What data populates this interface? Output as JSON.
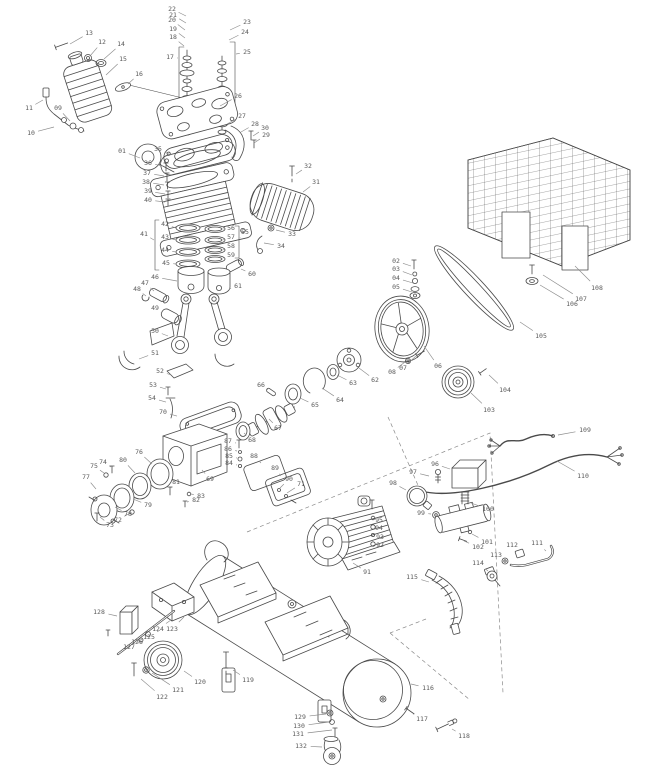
{
  "meta": {
    "title": "Air compressor exploded parts diagram"
  },
  "diagram": {
    "colors": {
      "line": "#4a4a4a",
      "dash": "#8a8a8a",
      "label": "#595959",
      "leader": "#8c8c8c",
      "background": "#ffffff"
    },
    "parts": [
      {
        "n": "01",
        "x": 122,
        "y": 151,
        "tx": 140,
        "ty": 158
      },
      {
        "n": "02",
        "x": 396,
        "y": 261,
        "tx": 411,
        "ty": 266
      },
      {
        "n": "03",
        "x": 396,
        "y": 269,
        "tx": 412,
        "ty": 275
      },
      {
        "n": "04",
        "x": 396,
        "y": 278,
        "tx": 413,
        "ty": 283
      },
      {
        "n": "05",
        "x": 396,
        "y": 287,
        "tx": 412,
        "ty": 292
      },
      {
        "n": "06",
        "x": 438,
        "y": 366,
        "tx": 424,
        "ty": 346
      },
      {
        "n": "07",
        "x": 403,
        "y": 368,
        "tx": 416,
        "ty": 356
      },
      {
        "n": "08",
        "x": 392,
        "y": 372,
        "tx": 405,
        "ty": 362
      },
      {
        "n": "09",
        "x": 58,
        "y": 108,
        "tx": 70,
        "ty": 121
      },
      {
        "n": "10",
        "x": 31,
        "y": 133,
        "tx": 54,
        "ty": 127
      },
      {
        "n": "11",
        "x": 29,
        "y": 108,
        "tx": 43,
        "ty": 100
      },
      {
        "n": "12",
        "x": 102,
        "y": 42,
        "tx": 90,
        "ty": 56
      },
      {
        "n": "13",
        "x": 89,
        "y": 33,
        "tx": 70,
        "ty": 44
      },
      {
        "n": "14",
        "x": 121,
        "y": 44,
        "tx": 104,
        "ty": 59
      },
      {
        "n": "15",
        "x": 123,
        "y": 59,
        "tx": 106,
        "ty": 75
      },
      {
        "n": "16",
        "x": 139,
        "y": 74,
        "tx": 128,
        "ty": 84
      },
      {
        "n": "17",
        "x": 170,
        "y": 57,
        "tx": 178,
        "ty": 58
      },
      {
        "n": "18",
        "x": 173,
        "y": 37,
        "tx": 184,
        "ty": 46
      },
      {
        "n": "19",
        "x": 173,
        "y": 29,
        "tx": 185,
        "ty": 38
      },
      {
        "n": "20",
        "x": 172,
        "y": 20,
        "tx": 185,
        "ty": 30
      },
      {
        "n": "21",
        "x": 173,
        "y": 15,
        "tx": 186,
        "ty": 23
      },
      {
        "n": "22",
        "x": 172,
        "y": 9,
        "tx": 186,
        "ty": 16
      },
      {
        "n": "23",
        "x": 247,
        "y": 22,
        "tx": 230,
        "ty": 30
      },
      {
        "n": "24",
        "x": 245,
        "y": 32,
        "tx": 229,
        "ty": 40
      },
      {
        "n": "25",
        "x": 247,
        "y": 52,
        "tx": 236,
        "ty": 54
      },
      {
        "n": "26",
        "x": 238,
        "y": 96,
        "tx": 220,
        "ty": 106
      },
      {
        "n": "27",
        "x": 242,
        "y": 116,
        "tx": 227,
        "ty": 124
      },
      {
        "n": "28",
        "x": 255,
        "y": 124,
        "tx": 241,
        "ty": 132
      },
      {
        "n": "29",
        "x": 266,
        "y": 135,
        "tx": 254,
        "ty": 143
      },
      {
        "n": "30",
        "x": 265,
        "y": 128,
        "tx": 253,
        "ty": 136
      },
      {
        "n": "31",
        "x": 316,
        "y": 182,
        "tx": 303,
        "ty": 192
      },
      {
        "n": "32",
        "x": 308,
        "y": 166,
        "tx": 296,
        "ty": 174
      },
      {
        "n": "33",
        "x": 292,
        "y": 234,
        "tx": 276,
        "ty": 230
      },
      {
        "n": "34",
        "x": 281,
        "y": 246,
        "tx": 264,
        "ty": 243
      },
      {
        "n": "35",
        "x": 158,
        "y": 149,
        "tx": 171,
        "ty": 155
      },
      {
        "n": "36",
        "x": 148,
        "y": 163,
        "tx": 163,
        "ty": 166
      },
      {
        "n": "37",
        "x": 147,
        "y": 173,
        "tx": 164,
        "ty": 176
      },
      {
        "n": "38",
        "x": 146,
        "y": 182,
        "tx": 164,
        "ty": 185
      },
      {
        "n": "39",
        "x": 148,
        "y": 191,
        "tx": 165,
        "ty": 194
      },
      {
        "n": "40",
        "x": 148,
        "y": 200,
        "tx": 165,
        "ty": 202
      },
      {
        "n": "41",
        "x": 144,
        "y": 234,
        "tx": 154,
        "ty": 240
      },
      {
        "n": "42",
        "x": 165,
        "y": 224,
        "tx": 176,
        "ty": 228
      },
      {
        "n": "43",
        "x": 165,
        "y": 237,
        "tx": 176,
        "ty": 240
      },
      {
        "n": "44",
        "x": 165,
        "y": 250,
        "tx": 176,
        "ty": 252
      },
      {
        "n": "45",
        "x": 166,
        "y": 263,
        "tx": 176,
        "ty": 264
      },
      {
        "n": "46",
        "x": 155,
        "y": 277,
        "tx": 177,
        "ty": 281
      },
      {
        "n": "47",
        "x": 145,
        "y": 283,
        "tx": 154,
        "ty": 291
      },
      {
        "n": "48",
        "x": 137,
        "y": 289,
        "tx": 146,
        "ty": 296
      },
      {
        "n": "49",
        "x": 155,
        "y": 308,
        "tx": 162,
        "ty": 313
      },
      {
        "n": "50",
        "x": 155,
        "y": 331,
        "tx": 168,
        "ty": 336
      },
      {
        "n": "51",
        "x": 155,
        "y": 353,
        "tx": 139,
        "ty": 359
      },
      {
        "n": "52",
        "x": 160,
        "y": 371,
        "tx": 171,
        "ty": 375
      },
      {
        "n": "53",
        "x": 153,
        "y": 385,
        "tx": 166,
        "ty": 389
      },
      {
        "n": "54",
        "x": 152,
        "y": 398,
        "tx": 166,
        "ty": 402
      },
      {
        "n": "55",
        "x": 245,
        "y": 232,
        "tx": 240,
        "ty": 238
      },
      {
        "n": "56",
        "x": 231,
        "y": 228,
        "tx": 223,
        "ty": 229
      },
      {
        "n": "57",
        "x": 231,
        "y": 237,
        "tx": 223,
        "ty": 240
      },
      {
        "n": "58",
        "x": 231,
        "y": 246,
        "tx": 223,
        "ty": 250
      },
      {
        "n": "59",
        "x": 231,
        "y": 255,
        "tx": 223,
        "ty": 258
      },
      {
        "n": "60",
        "x": 252,
        "y": 274,
        "tx": 241,
        "ty": 269
      },
      {
        "n": "61",
        "x": 238,
        "y": 286,
        "tx": 229,
        "ty": 289
      },
      {
        "n": "62",
        "x": 375,
        "y": 380,
        "tx": 359,
        "ty": 368
      },
      {
        "n": "63",
        "x": 353,
        "y": 383,
        "tx": 337,
        "ty": 375
      },
      {
        "n": "64",
        "x": 340,
        "y": 400,
        "tx": 322,
        "ty": 388
      },
      {
        "n": "65",
        "x": 315,
        "y": 405,
        "tx": 300,
        "ty": 398
      },
      {
        "n": "66",
        "x": 261,
        "y": 385,
        "tx": 268,
        "ty": 390
      },
      {
        "n": "67",
        "x": 278,
        "y": 428,
        "tx": 269,
        "ty": 419
      },
      {
        "n": "68",
        "x": 252,
        "y": 440,
        "tx": 244,
        "ty": 433
      },
      {
        "n": "69",
        "x": 210,
        "y": 479,
        "tx": 202,
        "ty": 470
      },
      {
        "n": "70",
        "x": 163,
        "y": 412,
        "tx": 177,
        "ty": 416
      },
      {
        "n": "71",
        "x": 301,
        "y": 484,
        "tx": 287,
        "ty": 493
      },
      {
        "n": "72",
        "x": 118,
        "y": 520,
        "tx": 130,
        "ty": 513
      },
      {
        "n": "73",
        "x": 110,
        "y": 525,
        "tx": 100,
        "ty": 517
      },
      {
        "n": "74",
        "x": 103,
        "y": 462,
        "tx": 111,
        "ty": 467
      },
      {
        "n": "75",
        "x": 94,
        "y": 466,
        "tx": 104,
        "ty": 473
      },
      {
        "n": "76",
        "x": 139,
        "y": 452,
        "tx": 152,
        "ty": 464
      },
      {
        "n": "77",
        "x": 86,
        "y": 477,
        "tx": 96,
        "ty": 489
      },
      {
        "n": "78",
        "x": 128,
        "y": 514,
        "tx": 115,
        "ty": 507
      },
      {
        "n": "79",
        "x": 148,
        "y": 505,
        "tx": 133,
        "ty": 499
      },
      {
        "n": "80",
        "x": 123,
        "y": 460,
        "tx": 135,
        "ty": 473
      },
      {
        "n": "81",
        "x": 176,
        "y": 482,
        "tx": 171,
        "ty": 488
      },
      {
        "n": "82",
        "x": 196,
        "y": 500,
        "tx": 187,
        "ty": 502
      },
      {
        "n": "83",
        "x": 201,
        "y": 496,
        "tx": 191,
        "ty": 494
      },
      {
        "n": "84",
        "x": 229,
        "y": 463,
        "tx": 237,
        "ty": 465
      },
      {
        "n": "85",
        "x": 229,
        "y": 456,
        "tx": 237,
        "ty": 458
      },
      {
        "n": "86",
        "x": 228,
        "y": 449,
        "tx": 237,
        "ty": 451
      },
      {
        "n": "87",
        "x": 228,
        "y": 441,
        "tx": 236,
        "ty": 443
      },
      {
        "n": "88",
        "x": 254,
        "y": 456,
        "tx": 261,
        "ty": 463
      },
      {
        "n": "89",
        "x": 275,
        "y": 468,
        "tx": 281,
        "ty": 476
      },
      {
        "n": "90",
        "x": 289,
        "y": 479,
        "tx": 280,
        "ty": 488
      },
      {
        "n": "91",
        "x": 367,
        "y": 572,
        "tx": 353,
        "ty": 563
      },
      {
        "n": "92",
        "x": 380,
        "y": 545,
        "tx": 376,
        "ty": 544
      },
      {
        "n": "93",
        "x": 380,
        "y": 537,
        "tx": 376,
        "ty": 536
      },
      {
        "n": "94",
        "x": 379,
        "y": 528,
        "tx": 375,
        "ty": 527
      },
      {
        "n": "95",
        "x": 379,
        "y": 520,
        "tx": 375,
        "ty": 518
      },
      {
        "n": "96",
        "x": 435,
        "y": 464,
        "tx": 450,
        "ty": 469
      },
      {
        "n": "97",
        "x": 413,
        "y": 472,
        "tx": 429,
        "ty": 476
      },
      {
        "n": "98",
        "x": 393,
        "y": 483,
        "tx": 406,
        "ty": 490
      },
      {
        "n": "99",
        "x": 421,
        "y": 513,
        "tx": 431,
        "ty": 514
      },
      {
        "n": "100",
        "x": 488,
        "y": 509,
        "tx": 471,
        "ty": 503
      },
      {
        "n": "101",
        "x": 487,
        "y": 542,
        "tx": 472,
        "ty": 534
      },
      {
        "n": "102",
        "x": 478,
        "y": 547,
        "tx": 464,
        "ty": 541
      },
      {
        "n": "103",
        "x": 489,
        "y": 410,
        "tx": 471,
        "ty": 393
      },
      {
        "n": "104",
        "x": 505,
        "y": 390,
        "tx": 489,
        "ty": 375
      },
      {
        "n": "105",
        "x": 541,
        "y": 336,
        "tx": 520,
        "ty": 322
      },
      {
        "n": "106",
        "x": 572,
        "y": 304,
        "tx": 540,
        "ty": 285
      },
      {
        "n": "107",
        "x": 581,
        "y": 299,
        "tx": 543,
        "ty": 275
      },
      {
        "n": "108",
        "x": 597,
        "y": 288,
        "tx": 575,
        "ty": 266
      },
      {
        "n": "109",
        "x": 585,
        "y": 430,
        "tx": 558,
        "ty": 435
      },
      {
        "n": "110",
        "x": 583,
        "y": 476,
        "tx": 557,
        "ty": 461
      },
      {
        "n": "111",
        "x": 537,
        "y": 543,
        "tx": 546,
        "ty": 551
      },
      {
        "n": "112",
        "x": 512,
        "y": 545,
        "tx": 519,
        "ty": 551
      },
      {
        "n": "113",
        "x": 496,
        "y": 555,
        "tx": 504,
        "ty": 560
      },
      {
        "n": "114",
        "x": 478,
        "y": 563,
        "tx": 488,
        "ty": 571
      },
      {
        "n": "115",
        "x": 412,
        "y": 577,
        "tx": 429,
        "ty": 582
      },
      {
        "n": "116",
        "x": 428,
        "y": 688,
        "tx": 411,
        "ty": 684
      },
      {
        "n": "117",
        "x": 422,
        "y": 719,
        "tx": 413,
        "ty": 714
      },
      {
        "n": "118",
        "x": 464,
        "y": 736,
        "tx": 452,
        "ty": 729
      },
      {
        "n": "119",
        "x": 248,
        "y": 680,
        "tx": 233,
        "ty": 670
      },
      {
        "n": "120",
        "x": 200,
        "y": 682,
        "tx": 184,
        "ty": 671
      },
      {
        "n": "121",
        "x": 178,
        "y": 690,
        "tx": 152,
        "ty": 673
      },
      {
        "n": "122",
        "x": 162,
        "y": 697,
        "tx": 141,
        "ty": 679
      },
      {
        "n": "123",
        "x": 172,
        "y": 629,
        "tx": 184,
        "ty": 617
      },
      {
        "n": "124",
        "x": 158,
        "y": 629,
        "tx": 171,
        "ty": 620
      },
      {
        "n": "125",
        "x": 149,
        "y": 637,
        "tx": 160,
        "ty": 630
      },
      {
        "n": "126",
        "x": 137,
        "y": 642,
        "tx": 146,
        "ty": 636
      },
      {
        "n": "127",
        "x": 129,
        "y": 647,
        "tx": 139,
        "ty": 642
      },
      {
        "n": "128",
        "x": 99,
        "y": 612,
        "tx": 117,
        "ty": 616
      },
      {
        "n": "129",
        "x": 300,
        "y": 717,
        "tx": 326,
        "ty": 714
      },
      {
        "n": "130",
        "x": 299,
        "y": 726,
        "tx": 329,
        "ty": 722
      },
      {
        "n": "131",
        "x": 298,
        "y": 734,
        "tx": 332,
        "ty": 730
      },
      {
        "n": "132",
        "x": 301,
        "y": 746,
        "tx": 322,
        "ty": 747
      }
    ]
  }
}
